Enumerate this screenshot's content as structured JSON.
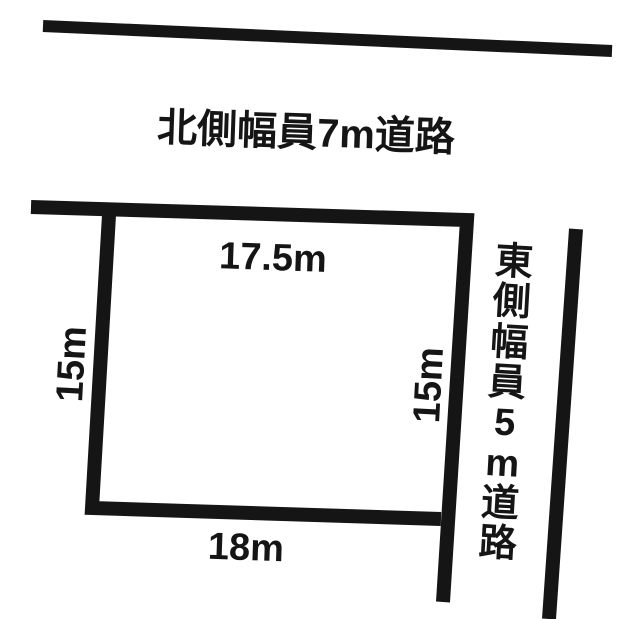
{
  "figure": {
    "kind": "land-plot-sketch",
    "north_road": {
      "label": "北側幅員7m道路"
    },
    "east_road": {
      "label": "東側幅員5m道路",
      "chars": [
        "東",
        "側",
        "幅",
        "員",
        "5",
        "m",
        "道",
        "路"
      ]
    },
    "parcel": {
      "dim_top": "17.5m",
      "dim_left": "15m",
      "dim_right": "15m",
      "dim_bottom": "18m"
    },
    "colors": {
      "ink": "#151515",
      "background": "#ffffff"
    }
  }
}
